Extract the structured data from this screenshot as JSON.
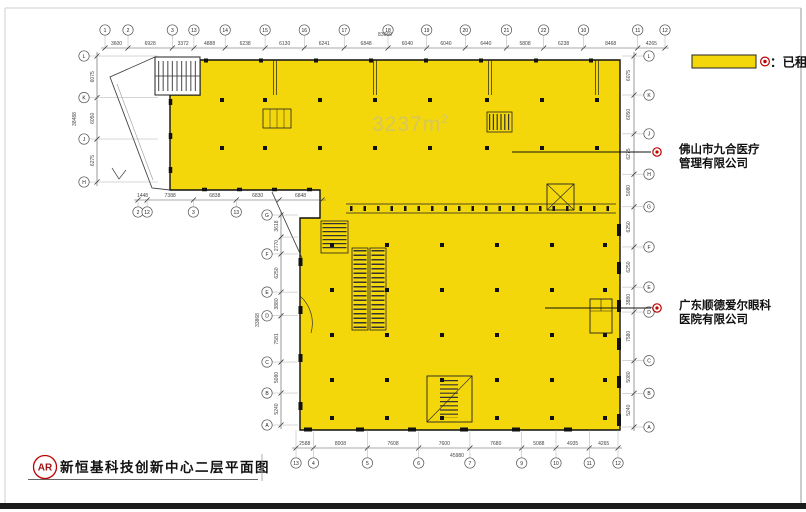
{
  "legend": {
    "label": "：已租",
    "symbol_name": "rented-marker",
    "swatch_color": "#F3D70B"
  },
  "area_label": {
    "value": "3237m",
    "sup": "2"
  },
  "annotations": [
    {
      "lines": [
        "佛山市九合医疗",
        "管理有限公司"
      ]
    },
    {
      "lines": [
        "广东顺德爱尔眼科",
        "医院有限公司"
      ]
    }
  ],
  "title_block": {
    "bubble": "AR",
    "title": "新恒基科技创新中心二层平面图"
  },
  "dimensions": {
    "top": {
      "overall": "83660",
      "segments": [
        "3600",
        "6928",
        "3372",
        "4888",
        "6238",
        "6130",
        "6241",
        "6848",
        "6040",
        "6040",
        "6440",
        "5808",
        "6238",
        "8468",
        "4265"
      ],
      "bubbles": [
        "1",
        "2",
        "3",
        "13",
        "14",
        "15",
        "16",
        "17",
        "18",
        "19",
        "20",
        "21",
        "22",
        "10",
        "11",
        "12"
      ]
    },
    "bottom": {
      "overall": "45980",
      "segments": [
        "2588",
        "8008",
        "7608",
        "7600",
        "7680",
        "5088",
        "4935",
        "4265"
      ],
      "bubbles": [
        "13",
        "4",
        "5",
        "6",
        "7",
        "9",
        "10",
        "11",
        "12"
      ]
    },
    "right": {
      "overall": "",
      "segments": [
        "6075",
        "6050",
        "6275",
        "5080",
        "6250",
        "6250",
        "3880",
        "7580",
        "5080",
        "5240"
      ],
      "bubbles": [
        "L",
        "K",
        "J",
        "H",
        "G",
        "F",
        "E",
        "D",
        "C",
        "B",
        "A"
      ]
    },
    "left_upper": {
      "overall": "38488",
      "segments": [
        "6075",
        "6050",
        "6275"
      ],
      "bubbles": [
        "L",
        "K",
        "J",
        "H"
      ]
    },
    "left_lower": {
      "overall": "33868",
      "segments": [
        "3618",
        "2770",
        "6250",
        "3880",
        "7581",
        "5080",
        "5240"
      ],
      "bubbles": [
        "G",
        null,
        "F",
        "E",
        "D",
        "C",
        "B",
        "A"
      ]
    },
    "mid": {
      "overall": "",
      "segments": [
        "1448",
        "7388",
        "6838",
        "6830",
        "6848"
      ],
      "bubbles": [
        "2",
        "12",
        "3",
        "13",
        null,
        null
      ]
    }
  }
}
